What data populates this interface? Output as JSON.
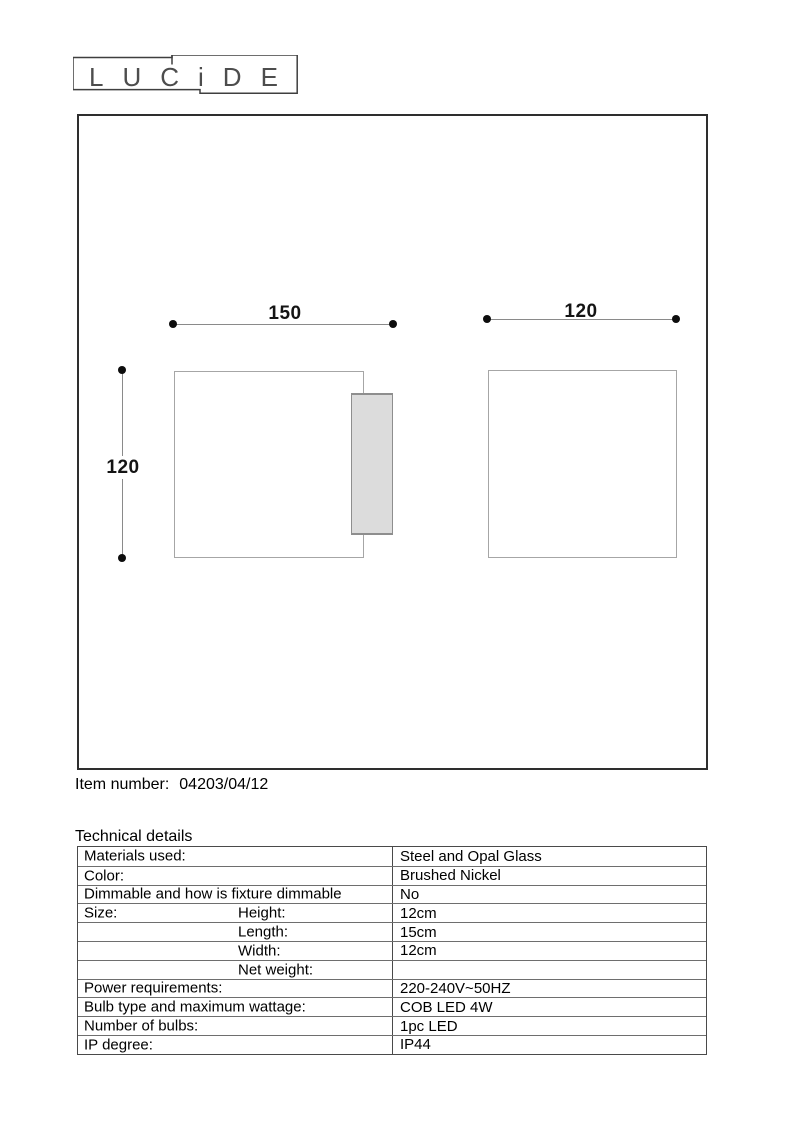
{
  "logo": {
    "text": "LUCiDE"
  },
  "diagram": {
    "side_view": {
      "width_label": "150",
      "height_label": "120"
    },
    "front_view": {
      "width_label": "120"
    }
  },
  "item_number": {
    "label": "Item number:",
    "value": "04203/04/12"
  },
  "section_title": "Technical details",
  "colors": {
    "glass_fill": "#dcdcdc",
    "drawing_outline": "#a6a6a6",
    "panel_border": "#2e2e2e"
  },
  "table": {
    "rows": [
      {
        "label": "Materials used:",
        "sublabel": "",
        "value": "Steel and Opal Glass"
      },
      {
        "label": "Color:",
        "sublabel": "",
        "value": "Brushed Nickel"
      },
      {
        "label": "Dimmable and how is fixture dimmable",
        "sublabel": "",
        "value": "No"
      },
      {
        "label": "Size:",
        "sublabel": "Height:",
        "value": "12cm"
      },
      {
        "label": "",
        "sublabel": "Length:",
        "value": "15cm"
      },
      {
        "label": "",
        "sublabel": "Width:",
        "value": "12cm"
      },
      {
        "label": "",
        "sublabel": "Net weight:",
        "value": ""
      },
      {
        "label": "Power requirements:",
        "sublabel": "",
        "value": "220-240V~50HZ"
      },
      {
        "label": "Bulb type and maximum wattage:",
        "sublabel": "",
        "value": "COB LED 4W"
      },
      {
        "label": "Number of bulbs:",
        "sublabel": "",
        "value": "1pc LED"
      },
      {
        "label": "IP degree:",
        "sublabel": "",
        "value": "IP44"
      }
    ]
  }
}
